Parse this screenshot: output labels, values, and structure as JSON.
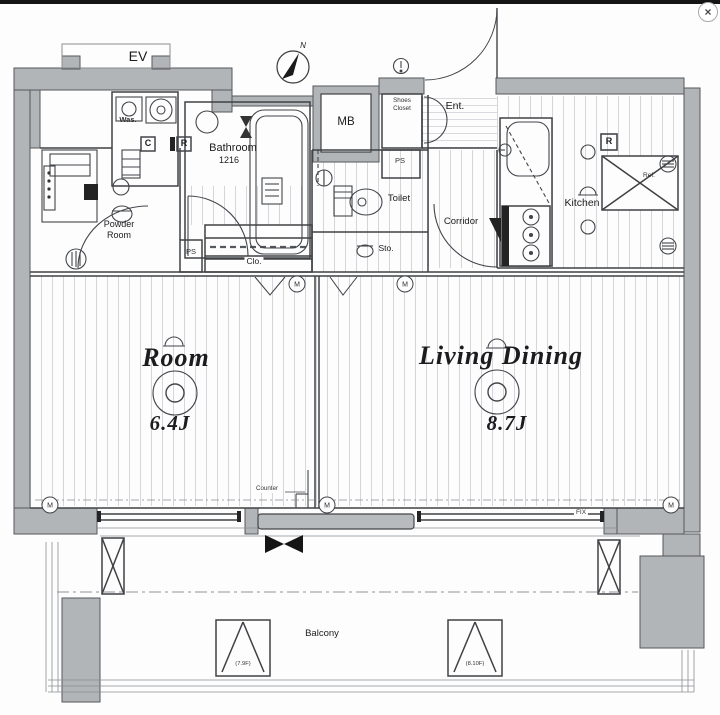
{
  "window": {
    "close_icon": "×"
  },
  "compass": {
    "north": "N"
  },
  "rooms": {
    "ev": "EV",
    "was": "Was.",
    "bathroom": "Bathroom",
    "bathroom_size": "1216",
    "mb": "MB",
    "shoes_line1": "Shoes",
    "shoes_line2": "Closet",
    "ent": "Ent.",
    "ps_top": "PS",
    "ps_left": "PS",
    "toilet": "Toilet",
    "corridor": "Corridor",
    "kitchen": "Kitchen",
    "ref": "Ref.",
    "powder_line1": "Powder",
    "powder_line2": "Room",
    "clo": "Clo.",
    "sto": "Sto.",
    "room": "Room",
    "room_size": "6.4J",
    "living": "Living Dining",
    "living_size": "8.7J",
    "balcony": "Balcony"
  },
  "annotations": {
    "box_c": "C",
    "box_r_bath": "R",
    "box_r_kitchen": "R",
    "counter": "Counter",
    "fix": "FIX",
    "hatch_left": "(7.9F)",
    "hatch_right": "(8.10F)",
    "m_symbol": "M"
  },
  "colors": {
    "wall_fill": "#b1b5b8",
    "line": "#3f4145",
    "floor_hatch": "#caccd2",
    "top_bar": "#151515"
  }
}
